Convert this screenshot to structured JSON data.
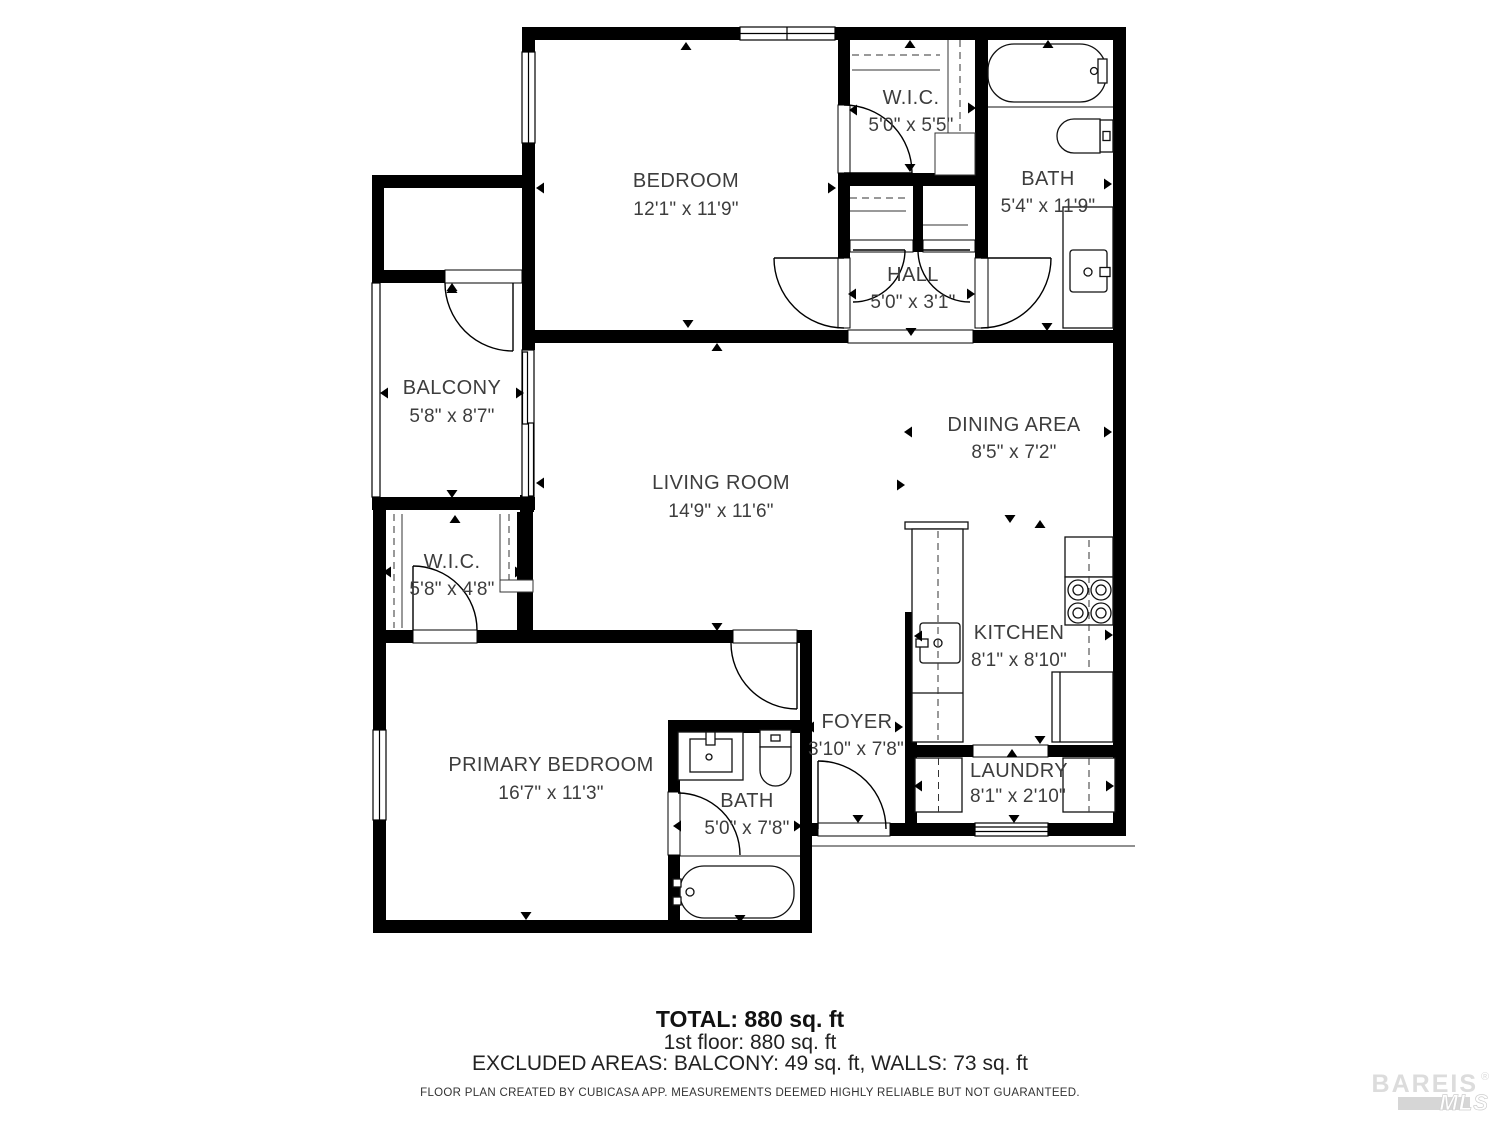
{
  "floor_plan": {
    "rooms": [
      {
        "id": "bedroom",
        "name": "BEDROOM",
        "dims": "12'1\" x 11'9\""
      },
      {
        "id": "wic-top",
        "name": "W.I.C.",
        "dims": "5'0\" x 5'5\""
      },
      {
        "id": "bath-top",
        "name": "BATH",
        "dims": "5'4\" x 11'9\""
      },
      {
        "id": "hall",
        "name": "HALL",
        "dims": "5'0\" x 3'1\""
      },
      {
        "id": "balcony",
        "name": "BALCONY",
        "dims": "5'8\" x 8'7\""
      },
      {
        "id": "living-room",
        "name": "LIVING ROOM",
        "dims": "14'9\" x 11'6\""
      },
      {
        "id": "dining-area",
        "name": "DINING AREA",
        "dims": "8'5\" x 7'2\""
      },
      {
        "id": "wic-lower",
        "name": "W.I.C.",
        "dims": "5'8\" x 4'8\""
      },
      {
        "id": "kitchen",
        "name": "KITCHEN",
        "dims": "8'1\" x 8'10\""
      },
      {
        "id": "primary-bedroom",
        "name": "PRIMARY BEDROOM",
        "dims": "16'7\" x 11'3\""
      },
      {
        "id": "bath-lower",
        "name": "BATH",
        "dims": "5'0\" x 7'8\""
      },
      {
        "id": "foyer",
        "name": "FOYER",
        "dims": "3'10\" x 7'8\""
      },
      {
        "id": "laundry",
        "name": "LAUNDRY",
        "dims": "8'1\" x 2'10\""
      }
    ],
    "footer": {
      "total": "TOTAL: 880 sq. ft",
      "floor": "1st floor: 880 sq. ft",
      "excluded": "EXCLUDED AREAS: BALCONY: 49 sq. ft, WALLS: 73 sq. ft",
      "disclaimer": "FLOOR PLAN CREATED BY CUBICASA APP. MEASUREMENTS DEEMED HIGHLY RELIABLE BUT NOT GUARANTEED."
    },
    "watermark": {
      "brand": "BAREIS",
      "reg": "®",
      "mls": "MLS"
    },
    "colors": {
      "wall": "#000000",
      "label": "#3d3d3d",
      "footer": "#1f1f1f",
      "watermark": "#dcdcdc"
    }
  }
}
